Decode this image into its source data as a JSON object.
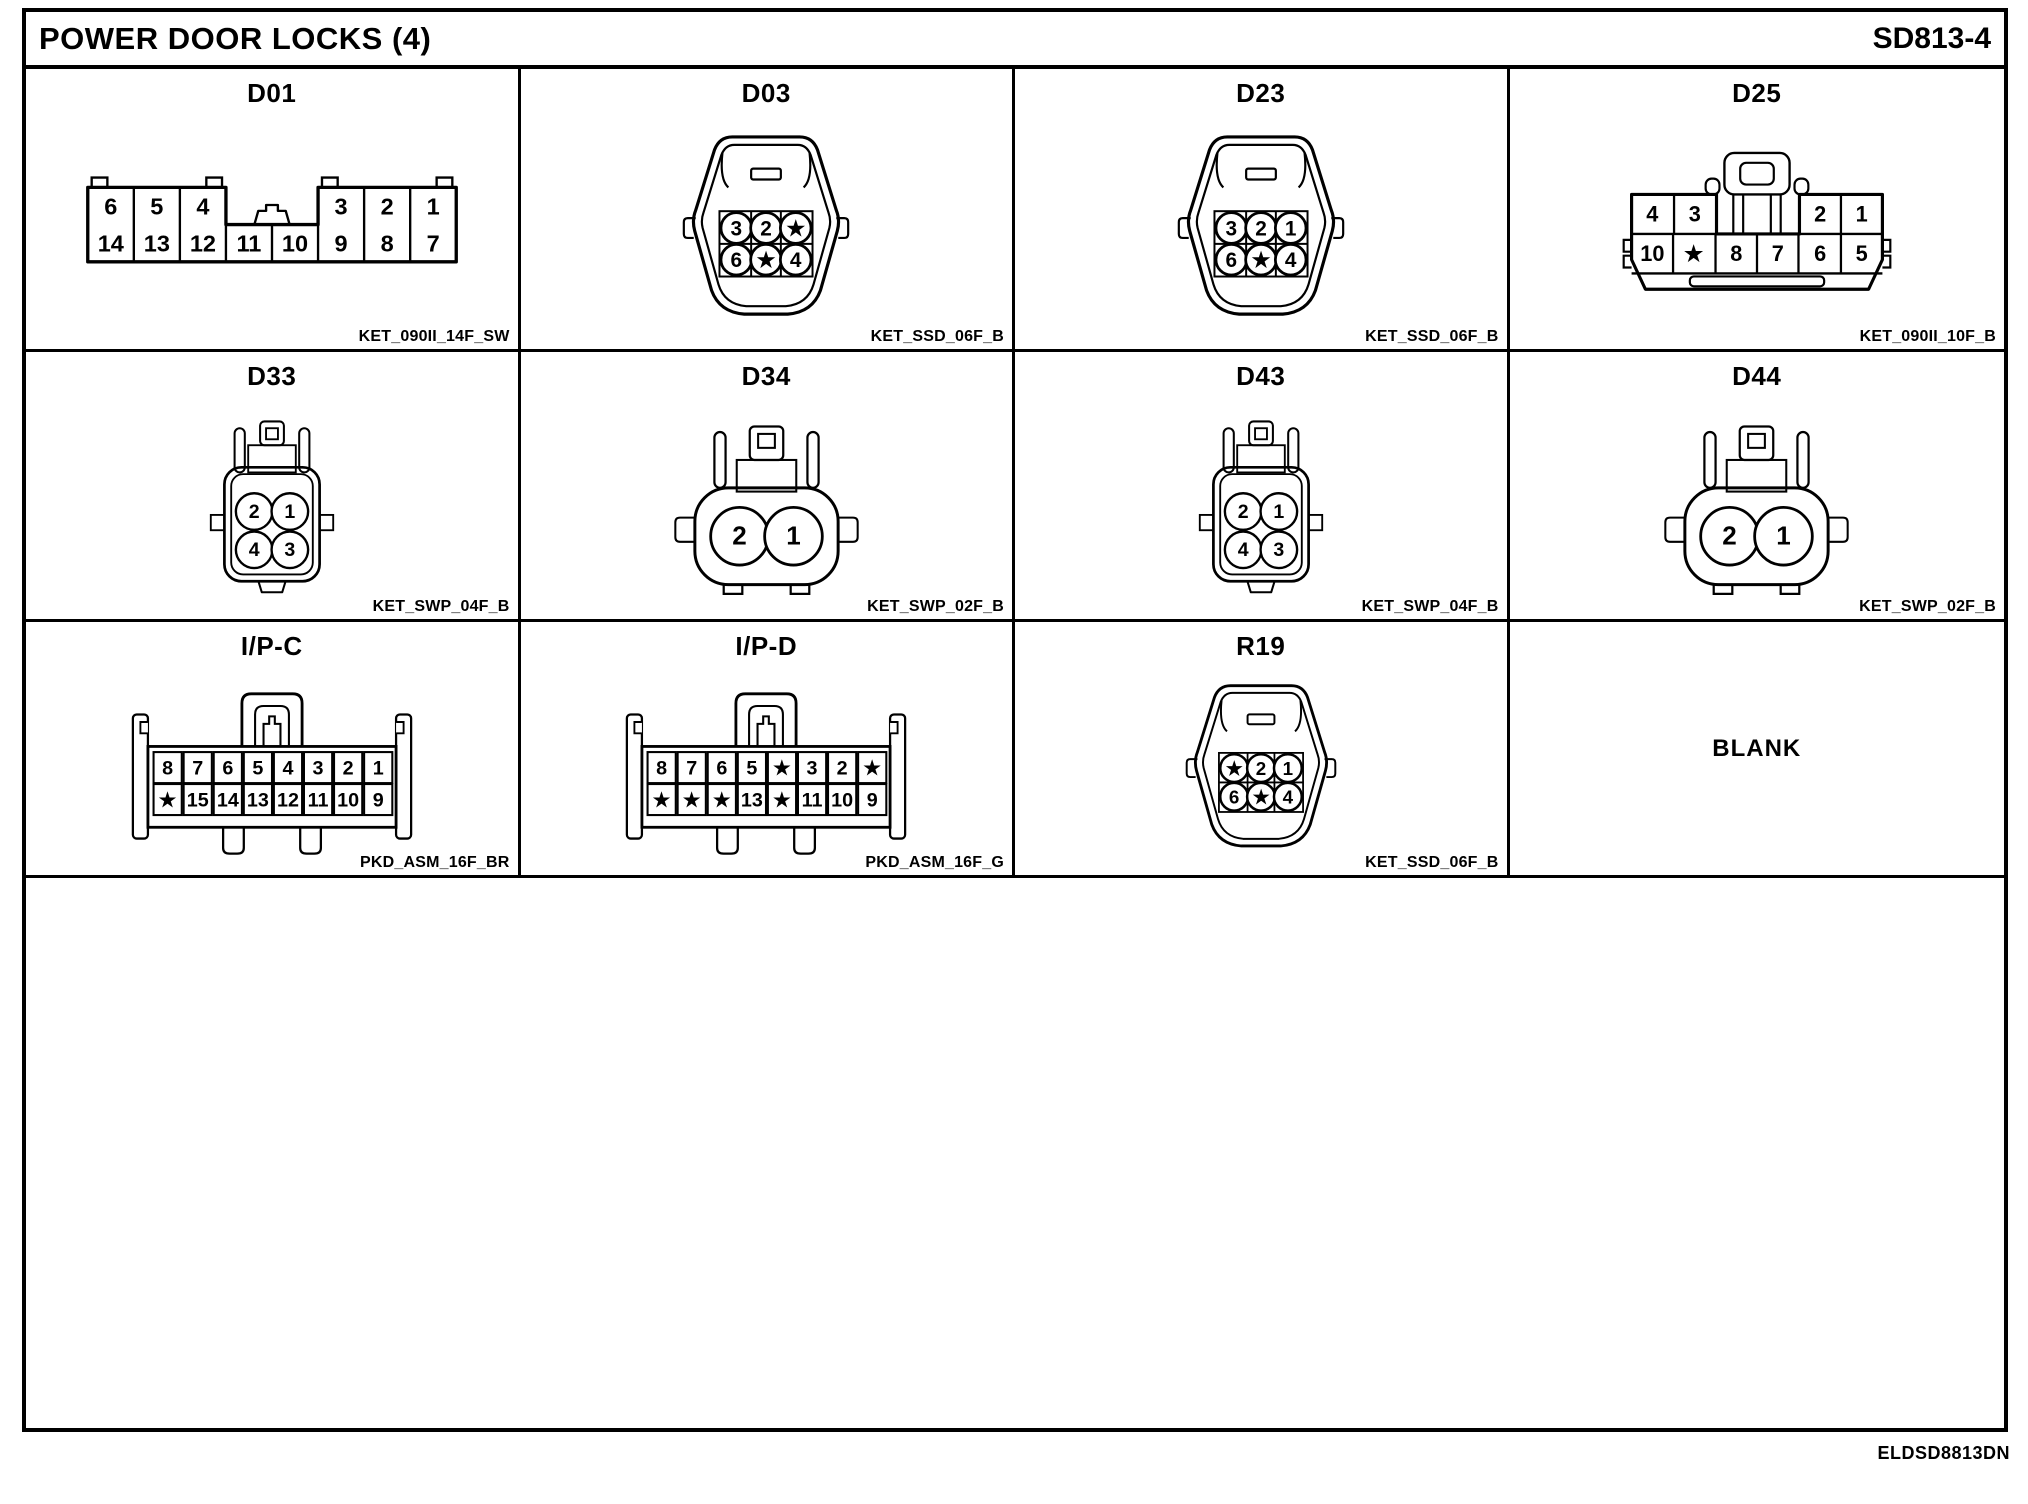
{
  "page": {
    "title": "POWER DOOR LOCKS (4)",
    "code": "SD813-4",
    "doc_id": "ELDSD8813DN",
    "blank_label": "BLANK",
    "ink_color": "#000000",
    "paper_color": "#ffffff"
  },
  "connectors": {
    "d01": {
      "title": "D01",
      "part": "KET_090II_14F_SW",
      "top_left": [
        "6",
        "5",
        "4"
      ],
      "top_right": [
        "3",
        "2",
        "1"
      ],
      "bottom": [
        "14",
        "13",
        "12",
        "11",
        "10",
        "9",
        "8",
        "7"
      ]
    },
    "d03": {
      "title": "D03",
      "part": "KET_SSD_06F_B",
      "top": [
        "3",
        "2",
        "★"
      ],
      "bottom": [
        "6",
        "★",
        "4"
      ]
    },
    "d23": {
      "title": "D23",
      "part": "KET_SSD_06F_B",
      "top": [
        "3",
        "2",
        "1"
      ],
      "bottom": [
        "6",
        "★",
        "4"
      ]
    },
    "d25": {
      "title": "D25",
      "part": "KET_090II_10F_B",
      "top": [
        "4",
        "3",
        "2",
        "1"
      ],
      "bottom": [
        "10",
        "★",
        "8",
        "7",
        "6",
        "5"
      ]
    },
    "d33": {
      "title": "D33",
      "part": "KET_SWP_04F_B",
      "top": [
        "2",
        "1"
      ],
      "bottom": [
        "4",
        "3"
      ]
    },
    "d34": {
      "title": "D34",
      "part": "KET_SWP_02F_B",
      "pins": [
        "2",
        "1"
      ]
    },
    "d43": {
      "title": "D43",
      "part": "KET_SWP_04F_B",
      "top": [
        "2",
        "1"
      ],
      "bottom": [
        "4",
        "3"
      ]
    },
    "d44": {
      "title": "D44",
      "part": "KET_SWP_02F_B",
      "pins": [
        "2",
        "1"
      ]
    },
    "ipc": {
      "title": "I/P-C",
      "part": "PKD_ASM_16F_BR",
      "top": [
        "8",
        "7",
        "6",
        "5",
        "4",
        "3",
        "2",
        "1"
      ],
      "bottom": [
        "★",
        "15",
        "14",
        "13",
        "12",
        "11",
        "10",
        "9"
      ]
    },
    "ipd": {
      "title": "I/P-D",
      "part": "PKD_ASM_16F_G",
      "top": [
        "8",
        "7",
        "6",
        "5",
        "★",
        "3",
        "2",
        "★"
      ],
      "bottom": [
        "★",
        "★",
        "★",
        "13",
        "★",
        "11",
        "10",
        "9"
      ]
    },
    "r19": {
      "title": "R19",
      "part": "KET_SSD_06F_B",
      "top": [
        "★",
        "2",
        "1"
      ],
      "bottom": [
        "6",
        "★",
        "4"
      ]
    }
  }
}
